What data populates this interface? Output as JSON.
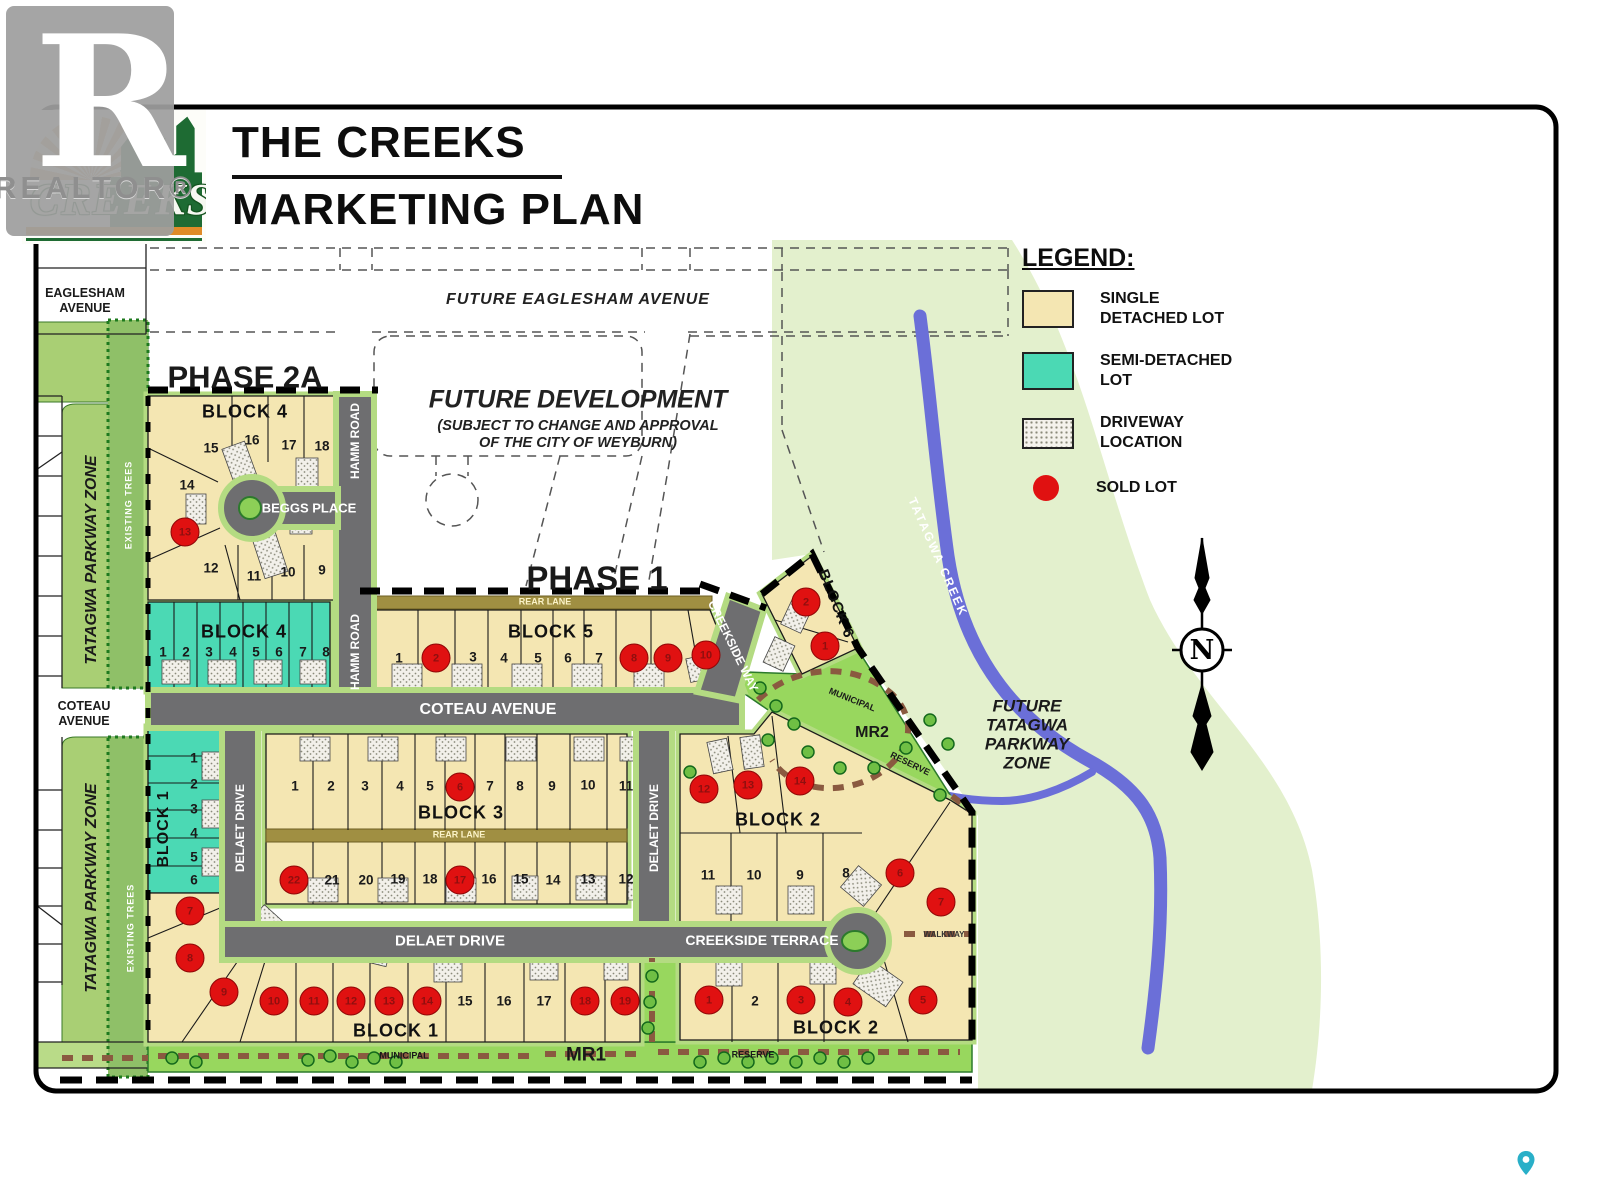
{
  "watermark": {
    "label": "REALTOR®"
  },
  "logo": {
    "the": "THE",
    "name": "CREEKS"
  },
  "title": {
    "line1": "THE CREEKS",
    "line2": "MARKETING PLAN"
  },
  "legend": {
    "heading": "LEGEND:",
    "items": [
      {
        "id": "single-detached",
        "line1": "SINGLE",
        "line2": "DETACHED LOT",
        "color": "#F4E6B2"
      },
      {
        "id": "semi-detached",
        "line1": "SEMI-DETACHED",
        "line2": "LOT",
        "color": "#4BD9B4"
      },
      {
        "id": "driveway-location",
        "line1": "DRIVEWAY",
        "line2": "LOCATION",
        "color": "hatch"
      },
      {
        "id": "sold-lot",
        "line1": "SOLD LOT",
        "line2": "",
        "color": "#E01111"
      }
    ]
  },
  "labels": {
    "phase2a": "PHASE 2A",
    "phase1": "PHASE 1",
    "future_eaglesham": "FUTURE  EAGLESHAM  AVENUE",
    "eaglesham_l1": "EAGLESHAM",
    "eaglesham_l2": "AVENUE",
    "coteau_l1": "COTEAU",
    "coteau_l2": "AVENUE",
    "future_dev_1": "FUTURE DEVELOPMENT",
    "future_dev_2": "(SUBJECT TO CHANGE AND APPROVAL",
    "future_dev_3": "OF THE CITY OF WEYBURN)",
    "tatagwa_parkway": "TATAGWA PARKWAY ZONE",
    "existing_trees": "EXISTING TREES",
    "hamm_road": "HAMM ROAD",
    "beggs_place": "BEGGS PLACE",
    "coteau_avenue": "COTEAU AVENUE",
    "creekside_way": "CREEKSIDE WAY",
    "delaet_drive": "DELAET DRIVE",
    "creekside_terrace": "CREEKSIDE TERRACE",
    "walkway": "WALKWAY",
    "rear_lane": "REAR  LANE",
    "municipal": "MUNICIPAL",
    "reserve": "RESERVE",
    "mr1": "MR1",
    "mr2": "MR2",
    "tatagwa_creek": "TATAGWA CREEK",
    "ft_1": "FUTURE",
    "ft_2": "TATAGWA",
    "ft_3": "PARKWAY",
    "ft_4": "ZONE",
    "north": "N"
  },
  "map": {
    "block_labels": [
      {
        "text": "BLOCK 4",
        "x": 245,
        "y": 412
      },
      {
        "text": "BLOCK 4",
        "x": 244,
        "y": 632
      },
      {
        "text": "BLOCK 5",
        "x": 551,
        "y": 632
      },
      {
        "text": "BLOCK 6",
        "x": 836,
        "y": 604,
        "rot": 68,
        "size": 15
      },
      {
        "text": "BLOCK 3",
        "x": 461,
        "y": 813
      },
      {
        "text": "BLOCK 1",
        "x": 164,
        "y": 829,
        "rot": -90,
        "size": 16
      },
      {
        "text": "BLOCK 1",
        "x": 396,
        "y": 1031
      },
      {
        "text": "BLOCK 2",
        "x": 778,
        "y": 820
      },
      {
        "text": "BLOCK 2",
        "x": 836,
        "y": 1028
      }
    ],
    "lot_blocks": [
      {
        "block": "Block 4 Phase 2A",
        "lots": [
          {
            "n": "14",
            "x": 187,
            "y": 485
          },
          {
            "n": "15",
            "x": 211,
            "y": 448
          },
          {
            "n": "16",
            "x": 252,
            "y": 440
          },
          {
            "n": "17",
            "x": 289,
            "y": 445
          },
          {
            "n": "18",
            "x": 322,
            "y": 446
          },
          {
            "n": "13",
            "x": 185,
            "y": 532,
            "sold": true
          },
          {
            "n": "12",
            "x": 211,
            "y": 568
          },
          {
            "n": "11",
            "x": 254,
            "y": 576
          },
          {
            "n": "10",
            "x": 288,
            "y": 572
          },
          {
            "n": "9",
            "x": 322,
            "y": 570
          }
        ]
      },
      {
        "block": "Block 4 semi-detached",
        "lots": [
          {
            "n": "1",
            "x": 163,
            "y": 652
          },
          {
            "n": "2",
            "x": 186,
            "y": 652
          },
          {
            "n": "3",
            "x": 209,
            "y": 652
          },
          {
            "n": "4",
            "x": 233,
            "y": 652
          },
          {
            "n": "5",
            "x": 256,
            "y": 652
          },
          {
            "n": "6",
            "x": 279,
            "y": 652
          },
          {
            "n": "7",
            "x": 303,
            "y": 652
          },
          {
            "n": "8",
            "x": 326,
            "y": 652
          }
        ]
      },
      {
        "block": "Block 5",
        "lots": [
          {
            "n": "1",
            "x": 399,
            "y": 658
          },
          {
            "n": "2",
            "x": 436,
            "y": 658,
            "sold": true
          },
          {
            "n": "3",
            "x": 473,
            "y": 657
          },
          {
            "n": "4",
            "x": 504,
            "y": 658
          },
          {
            "n": "5",
            "x": 538,
            "y": 658
          },
          {
            "n": "6",
            "x": 568,
            "y": 658
          },
          {
            "n": "7",
            "x": 599,
            "y": 658
          },
          {
            "n": "8",
            "x": 634,
            "y": 658,
            "sold": true
          },
          {
            "n": "9",
            "x": 668,
            "y": 658,
            "sold": true
          },
          {
            "n": "10",
            "x": 706,
            "y": 655,
            "sold": true
          }
        ]
      },
      {
        "block": "Block 6",
        "lots": [
          {
            "n": "2",
            "x": 806,
            "y": 602,
            "sold": true
          },
          {
            "n": "1",
            "x": 825,
            "y": 646,
            "sold": true
          }
        ]
      },
      {
        "block": "Block 3",
        "lots": [
          {
            "n": "1",
            "x": 295,
            "y": 786
          },
          {
            "n": "2",
            "x": 331,
            "y": 786
          },
          {
            "n": "3",
            "x": 365,
            "y": 786
          },
          {
            "n": "4",
            "x": 400,
            "y": 786
          },
          {
            "n": "5",
            "x": 430,
            "y": 786
          },
          {
            "n": "6",
            "x": 460,
            "y": 787,
            "sold": true
          },
          {
            "n": "7",
            "x": 490,
            "y": 786
          },
          {
            "n": "8",
            "x": 520,
            "y": 786
          },
          {
            "n": "9",
            "x": 552,
            "y": 786
          },
          {
            "n": "10",
            "x": 588,
            "y": 785
          },
          {
            "n": "11",
            "x": 626,
            "y": 786
          },
          {
            "n": "22",
            "x": 294,
            "y": 880,
            "sold": true
          },
          {
            "n": "21",
            "x": 332,
            "y": 880
          },
          {
            "n": "20",
            "x": 366,
            "y": 880
          },
          {
            "n": "19",
            "x": 398,
            "y": 879
          },
          {
            "n": "18",
            "x": 430,
            "y": 879
          },
          {
            "n": "17",
            "x": 460,
            "y": 880,
            "sold": true
          },
          {
            "n": "16",
            "x": 489,
            "y": 879
          },
          {
            "n": "15",
            "x": 521,
            "y": 879
          },
          {
            "n": "14",
            "x": 553,
            "y": 880
          },
          {
            "n": "13",
            "x": 588,
            "y": 879
          },
          {
            "n": "12",
            "x": 626,
            "y": 879
          }
        ]
      },
      {
        "block": "Block 1 semi-detached",
        "lots": [
          {
            "n": "1",
            "x": 194,
            "y": 758
          },
          {
            "n": "2",
            "x": 194,
            "y": 784
          },
          {
            "n": "3",
            "x": 194,
            "y": 809
          },
          {
            "n": "4",
            "x": 194,
            "y": 833
          },
          {
            "n": "5",
            "x": 194,
            "y": 857
          },
          {
            "n": "6",
            "x": 194,
            "y": 880
          }
        ]
      },
      {
        "block": "Block 1",
        "lots": [
          {
            "n": "7",
            "x": 190,
            "y": 911,
            "sold": true
          },
          {
            "n": "8",
            "x": 190,
            "y": 958,
            "sold": true
          },
          {
            "n": "9",
            "x": 224,
            "y": 992,
            "sold": true
          },
          {
            "n": "10",
            "x": 274,
            "y": 1001,
            "sold": true
          },
          {
            "n": "11",
            "x": 314,
            "y": 1001,
            "sold": true
          },
          {
            "n": "12",
            "x": 351,
            "y": 1001,
            "sold": true
          },
          {
            "n": "13",
            "x": 389,
            "y": 1001,
            "sold": true
          },
          {
            "n": "14",
            "x": 427,
            "y": 1001,
            "sold": true
          },
          {
            "n": "15",
            "x": 465,
            "y": 1001
          },
          {
            "n": "16",
            "x": 504,
            "y": 1001
          },
          {
            "n": "17",
            "x": 544,
            "y": 1001
          },
          {
            "n": "18",
            "x": 585,
            "y": 1001,
            "sold": true
          },
          {
            "n": "19",
            "x": 625,
            "y": 1001,
            "sold": true
          }
        ]
      },
      {
        "block": "Block 2",
        "lots": [
          {
            "n": "12",
            "x": 704,
            "y": 789,
            "sold": true
          },
          {
            "n": "13",
            "x": 748,
            "y": 785,
            "sold": true
          },
          {
            "n": "14",
            "x": 800,
            "y": 781,
            "sold": true
          },
          {
            "n": "11",
            "x": 708,
            "y": 875
          },
          {
            "n": "10",
            "x": 754,
            "y": 875
          },
          {
            "n": "9",
            "x": 800,
            "y": 875
          },
          {
            "n": "8",
            "x": 846,
            "y": 873
          },
          {
            "n": "6",
            "x": 900,
            "y": 873,
            "sold": true
          },
          {
            "n": "7",
            "x": 941,
            "y": 902,
            "sold": true
          },
          {
            "n": "1",
            "x": 709,
            "y": 1000,
            "sold": true
          },
          {
            "n": "2",
            "x": 755,
            "y": 1001
          },
          {
            "n": "3",
            "x": 801,
            "y": 1000,
            "sold": true
          },
          {
            "n": "4",
            "x": 848,
            "y": 1002,
            "sold": true
          },
          {
            "n": "5",
            "x": 923,
            "y": 1000,
            "sold": true
          }
        ]
      }
    ]
  },
  "colors": {
    "single_lot": "#F4E6B2",
    "semi_lot": "#4BD9B4",
    "sold": "#E01111",
    "road": "#6E6E70",
    "reserve_green": "#98D75E",
    "parkway_green": "#A9CF74",
    "pale_green": "#E3F0CD",
    "creek_blue": "#6B6FD8",
    "rear_lane": "#A08F42",
    "path_brown": "#8A5A40"
  }
}
